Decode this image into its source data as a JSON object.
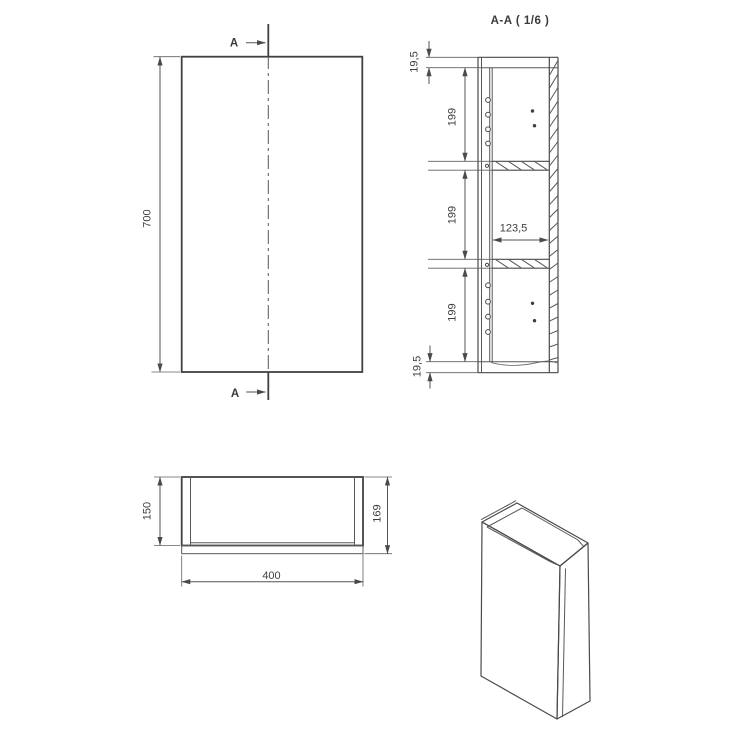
{
  "drawing": {
    "labels": {
      "section_marker_top": "A",
      "section_marker_bottom": "A",
      "section_title": "A-A ( 1/6 )",
      "front_height": "700",
      "top_thickness": "19,5",
      "bottom_thickness": "19,5",
      "spacing_1": "199",
      "spacing_2": "199",
      "spacing_3": "199",
      "inner_depth": "123,5",
      "carcass_depth": "150",
      "overall_depth": "169",
      "overall_width": "400"
    },
    "colors": {
      "background": "#ffffff",
      "line": "#4a4a4a",
      "text": "#3f3f3f"
    }
  }
}
